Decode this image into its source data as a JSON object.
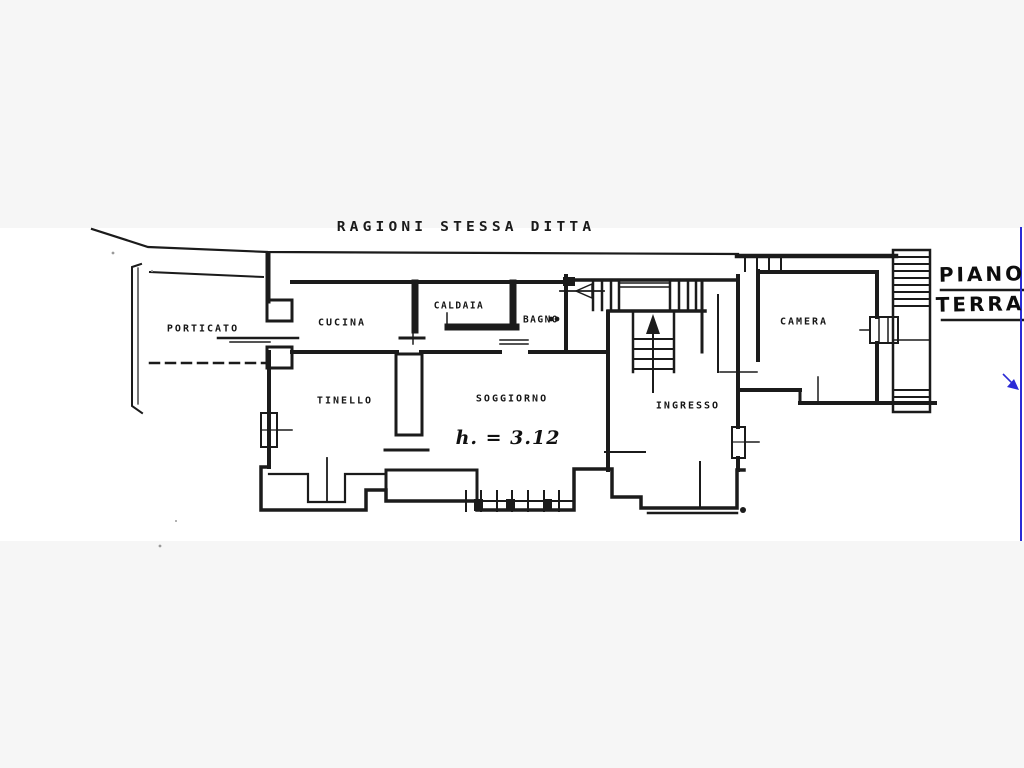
{
  "title_note": "RAGIONI STESSA DITTA",
  "floor_plan": {
    "floor_label": {
      "line1": "PIANO",
      "line2": "TERRA"
    },
    "height_annotation": "h. = 3.12",
    "rooms": [
      {
        "id": "porticato",
        "label": "PORTICATO"
      },
      {
        "id": "cucina",
        "label": "CUCINA"
      },
      {
        "id": "caldaia",
        "label": "CALDAIA"
      },
      {
        "id": "bagno",
        "label": "BAGNO"
      },
      {
        "id": "camera",
        "label": "CAMERA"
      },
      {
        "id": "tinello",
        "label": "TINELLO"
      },
      {
        "id": "soggiorno",
        "label": "SOGGIORNO"
      },
      {
        "id": "ingresso",
        "label": "INGRESSO"
      }
    ]
  },
  "colors": {
    "ink": "#1b1b1b",
    "annotation_blue": "#2b2bd6",
    "paper": "#ffffff",
    "margin_gray": "#f6f6f6"
  }
}
